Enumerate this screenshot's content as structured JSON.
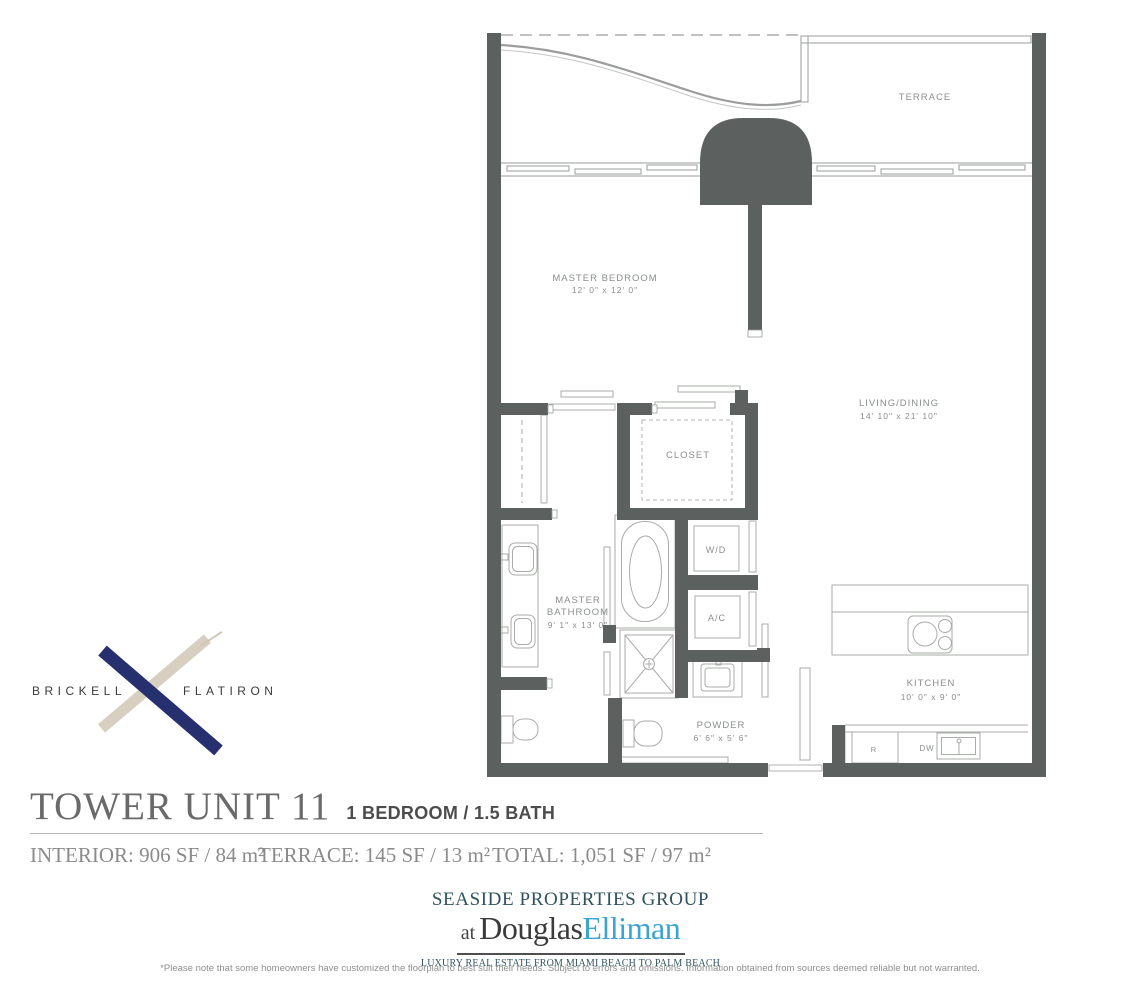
{
  "brand": {
    "name_left": "BRICKELL",
    "name_right": "FLATIRON",
    "x_navy_color": "#26306e",
    "x_tan_color": "#d7d0c0"
  },
  "plan": {
    "terrace": {
      "label": "TERRACE"
    },
    "master_bedroom": {
      "label": "MASTER BEDROOM",
      "dims": "12' 0\" x 12' 0\""
    },
    "living_dining": {
      "label": "LIVING/DINING",
      "dims": "14' 10\" x 21' 10\""
    },
    "closet": {
      "label": "CLOSET"
    },
    "master_bathroom": {
      "line1": "MASTER",
      "line2": "BATHROOM",
      "dims": "9' 1\" x 13' 0\""
    },
    "washer_dryer": {
      "label": "W/D"
    },
    "ac": {
      "label": "A/C"
    },
    "powder": {
      "label": "POWDER",
      "dims": "6' 6\" x 5' 6\""
    },
    "kitchen": {
      "label": "KITCHEN",
      "dims": "10' 0\" x 9' 0\""
    },
    "refrigerator": {
      "label": "R"
    },
    "dishwasher": {
      "label": "DW"
    }
  },
  "title": {
    "unit": "TOWER UNIT 11",
    "config": "1 BEDROOM / 1.5 BATH"
  },
  "stats": {
    "interior": "INTERIOR: 906 SF / 84 m²",
    "terrace": "TERRACE: 145 SF / 13 m²",
    "total": "TOTAL: 1,051 SF / 97 m²"
  },
  "broker": {
    "group": "SEASIDE PROPERTIES GROUP",
    "at": "at",
    "name_dark": "Douglas",
    "name_blue": "Elliman",
    "elliman_blue_color": "#3ba4d2",
    "group_color": "#30525e",
    "tagline": "LUXURY REAL ESTATE FROM MIAMI BEACH TO PALM BEACH"
  },
  "disclaimer": "*Please note that some homeowners have customized the floorplan to best suit their needs. Subject to errors and omissions. Information obtained from sources deemed reliable but not warranted."
}
